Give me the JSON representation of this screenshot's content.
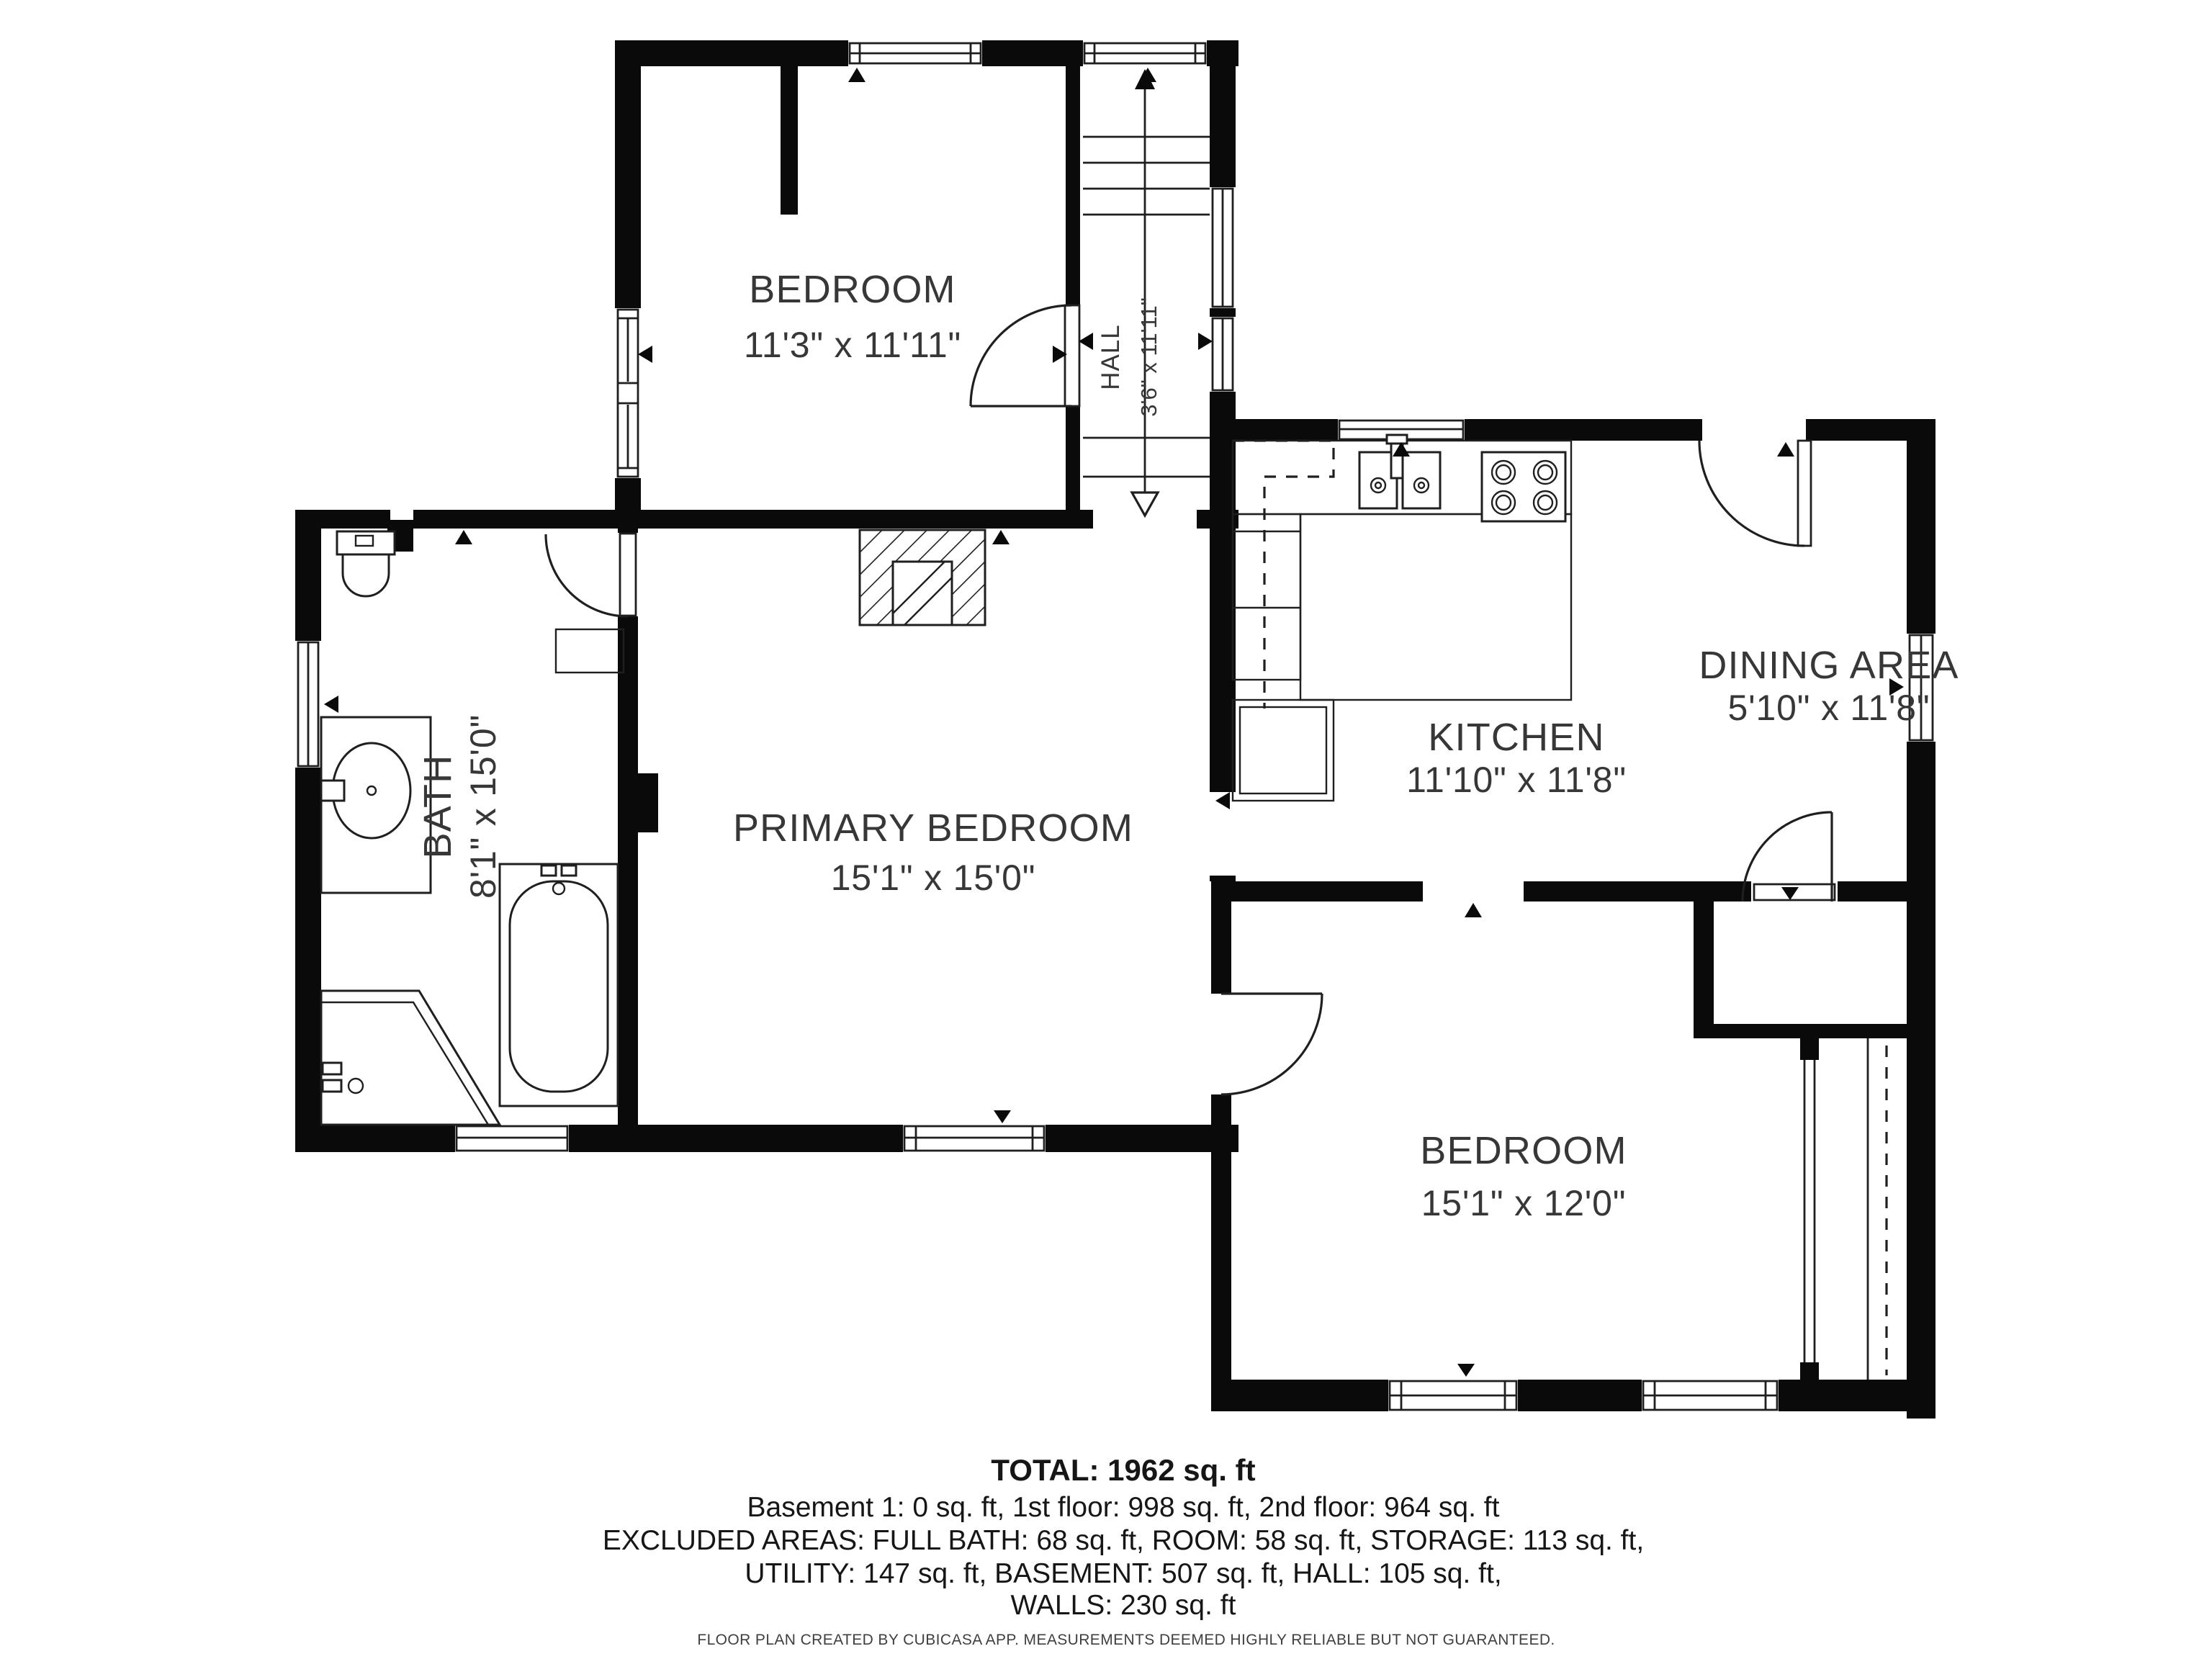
{
  "plan": {
    "rooms": [
      {
        "name": "BEDROOM",
        "dims": "11'3\" x 11'11\""
      },
      {
        "name": "HALL",
        "dims": "3'6\" x 11'11\""
      },
      {
        "name": "KITCHEN",
        "dims": "11'10\" x 11'8\""
      },
      {
        "name": "DINING AREA",
        "dims": "5'10\" x 11'8\""
      },
      {
        "name": "BATH",
        "dims": "8'1\" x 15'0\""
      },
      {
        "name": "PRIMARY BEDROOM",
        "dims": "15'1\" x 15'0\""
      },
      {
        "name": "BEDROOM",
        "dims": "15'1\" x 12'0\""
      }
    ]
  },
  "summary": {
    "total": "TOTAL: 1962 sq. ft",
    "floors": "Basement 1: 0 sq. ft, 1st floor: 998 sq. ft, 2nd floor: 964 sq. ft",
    "excluded1": "EXCLUDED AREAS: FULL BATH: 68 sq. ft, ROOM: 58 sq. ft, STORAGE: 113 sq. ft,",
    "excluded2": "UTILITY: 147 sq. ft, BASEMENT: 507 sq. ft, HALL: 105 sq. ft,",
    "excluded3": "WALLS: 230 sq. ft"
  },
  "footer": "FLOOR PLAN CREATED BY CUBICASA APP. MEASUREMENTS DEEMED HIGHLY RELIABLE BUT NOT GUARANTEED.",
  "colors": {
    "wall": "#0a0a0a",
    "line": "#1f1f1f",
    "label": "#373737",
    "summary": "#161616",
    "bg": "#ffffff"
  }
}
